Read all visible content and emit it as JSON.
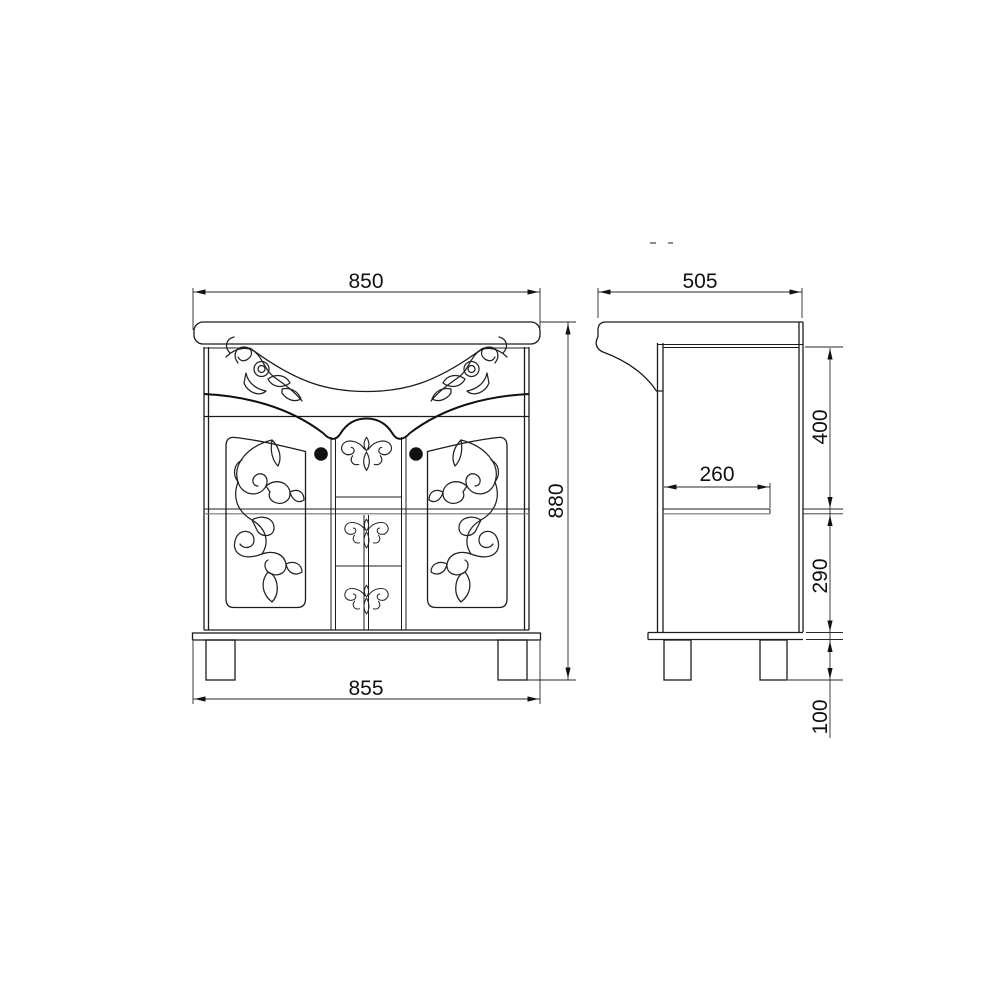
{
  "dimensions": {
    "front": {
      "width_top": "850",
      "height": "880",
      "width_bottom": "855"
    },
    "side": {
      "depth": "505",
      "shelf_depth": "260",
      "upper_section": "400",
      "lower_section": "290",
      "leg_height": "100"
    }
  },
  "colors": {
    "background": "#ffffff",
    "line": "#1c1c1c",
    "secondary_line": "#767676",
    "dimension_text": "#111111"
  }
}
